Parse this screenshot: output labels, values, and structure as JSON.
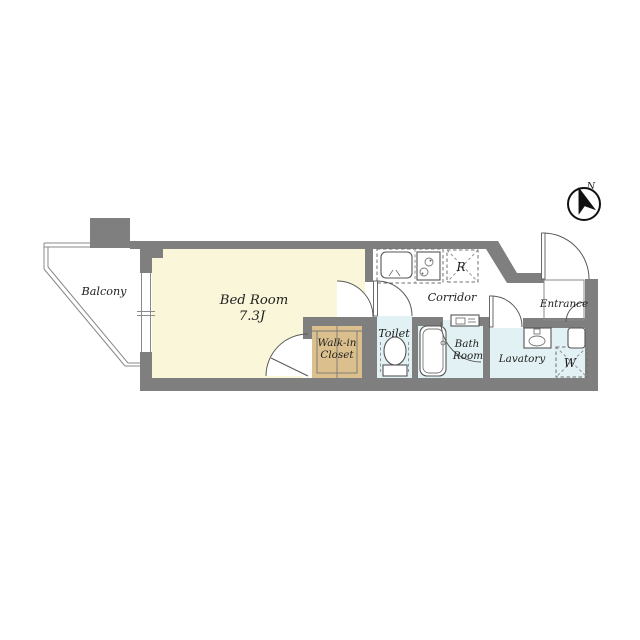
{
  "plan_title": "1K apartment floor plan",
  "colors": {
    "wall": "#7f7f7f",
    "bedroom_floor": "#faf6d9",
    "closet_floor": "#dbc08d",
    "wet_area_floor": "#e2f1f3",
    "white": "#ffffff"
  },
  "compass": {
    "north": "N"
  },
  "rooms": {
    "balcony": {
      "name": "Balcony"
    },
    "bedroom": {
      "name": "Bed Room",
      "area": "7.3J"
    },
    "walk_in_closet": {
      "line1": "Walk-in",
      "line2": "Closet"
    },
    "toilet": {
      "name": "Toilet"
    },
    "corridor": {
      "name": "Corridor"
    },
    "bath": {
      "line1": "Bath",
      "line2": "Room"
    },
    "lavatory": {
      "name": "Lavatory"
    },
    "entrance": {
      "name": "Entrance"
    },
    "refrigerator_space": {
      "abbr": "R"
    },
    "washer_space": {
      "abbr": "W"
    }
  }
}
